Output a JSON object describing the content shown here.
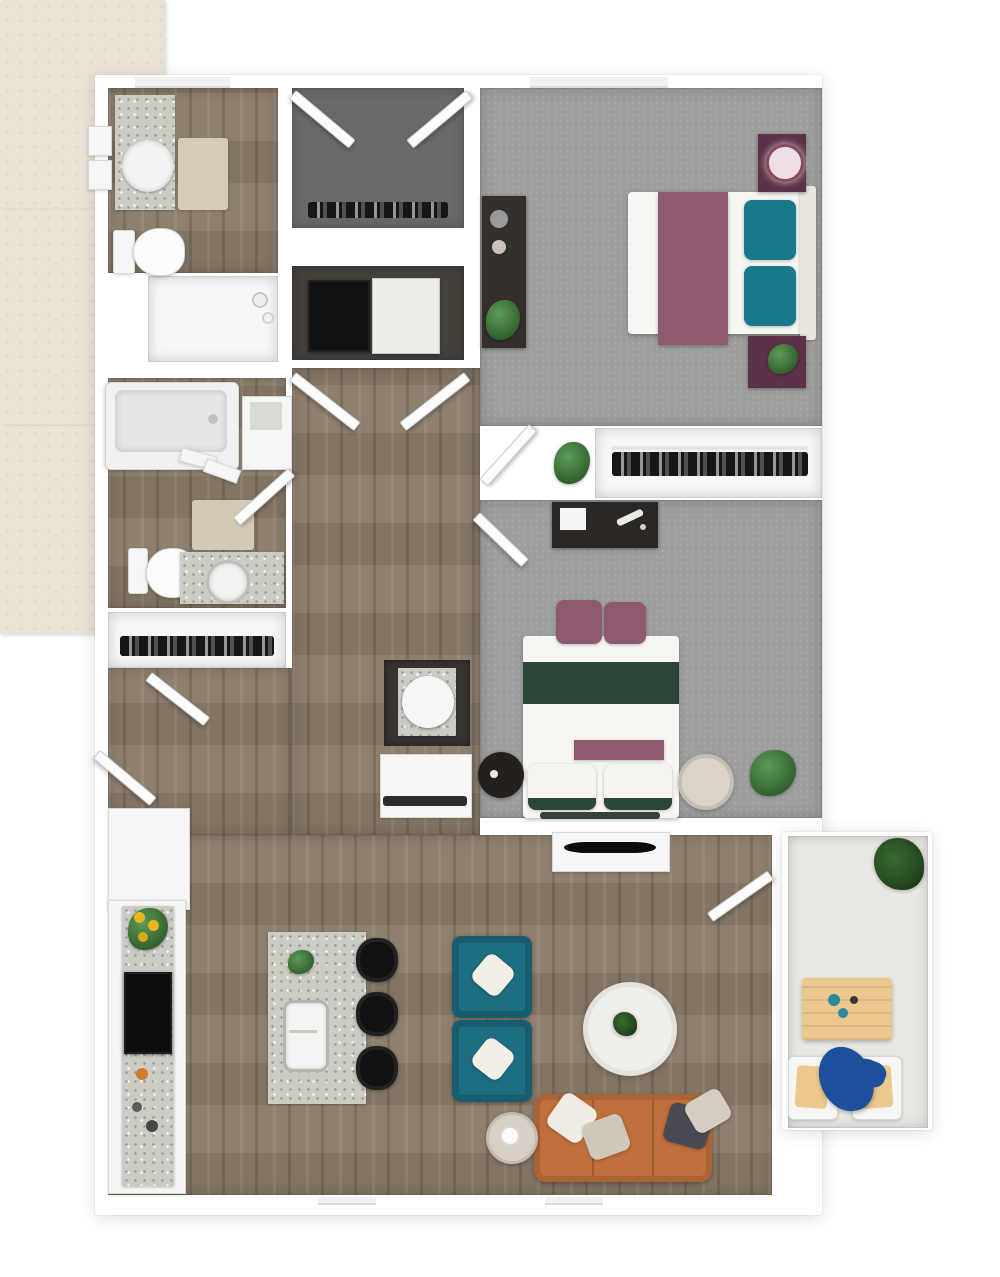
{
  "meta": {
    "type": "3d-floor-plan-render",
    "visible_text": "none",
    "unit_summary": "2-bedroom 2-bathroom apartment with kitchen, living room and patio"
  },
  "palette": {
    "wall": "#ffffff",
    "wood": "#8a7a68",
    "carpet": "#9e9e9e",
    "closet_floor": "#696969",
    "utility_floor": "#46403b",
    "alcove": "#3a3430",
    "white_floor": "#f7f7f5",
    "rug": "#e9e3d5",
    "granite": "#ccccc4",
    "teal": "#1d6e81",
    "teal_pillow": "#18798a",
    "plum": "#8e5a70",
    "plum_dark": "#5d3147",
    "green_dark": "#2a4737",
    "plant_green": "#5d9b57",
    "plant_dark": "#1f3d1b",
    "sofa_orange": "#c06f3d",
    "patio_floor": "#eae8e3",
    "patio_table": "#eac88e",
    "patio_blue": "#1d4f9c",
    "appliance_black": "#111111",
    "mat_beige": "#d6cbb8"
  },
  "rooms": [
    {
      "name": "bathroom-1",
      "position": "top-left",
      "floor": "wood",
      "items": [
        "vanity-with-vessel-sink",
        "wall-towels-x2",
        "bath-mat",
        "toilet",
        "walk-in-shower"
      ]
    },
    {
      "name": "entry-closet",
      "position": "top-center",
      "floor": "dark-gray",
      "items": [
        "double-swing-doors",
        "hanging-rod-with-clothes"
      ]
    },
    {
      "name": "laundry-closet",
      "position": "upper-center",
      "floor": "dark",
      "items": [
        "washer-black",
        "dryer-white",
        "double-swing-doors"
      ]
    },
    {
      "name": "bedroom-1",
      "position": "top-right",
      "floor": "gray-carpet",
      "items": [
        "window",
        "area-rug",
        "bed-with-plum-runner",
        "teal-pillows-x2",
        "nightstand-with-lamp",
        "nightstand-with-plant",
        "dresser-with-decor",
        "plant"
      ]
    },
    {
      "name": "bedroom-1-closet",
      "position": "center-right",
      "floor": "white",
      "items": [
        "hanging-rod-with-clothes",
        "plant-at-entry"
      ]
    },
    {
      "name": "bathroom-2",
      "position": "middle-left",
      "floor": "wood",
      "items": [
        "bathtub",
        "storage-niche",
        "towel-bar",
        "bath-mat",
        "toilet",
        "vanity-with-round-sink",
        "swing-door"
      ]
    },
    {
      "name": "hall-closet",
      "position": "middle-left-lower",
      "floor": "white",
      "items": [
        "hanging-rod-with-clothes"
      ]
    },
    {
      "name": "utility-nook",
      "position": "center",
      "floor": "white",
      "items": [
        "basin-unit-on-granite-base",
        "lower-cubby-with-rail"
      ]
    },
    {
      "name": "bedroom-2",
      "position": "middle-right",
      "floor": "gray-carpet",
      "items": [
        "dresser-with-decor",
        "swing-door",
        "area-rug",
        "bed-with-green-stripe",
        "plum-pillows-x2",
        "white-pillows-x2",
        "round-side-table-dark",
        "round-side-table-light",
        "plant"
      ]
    },
    {
      "name": "living-room",
      "position": "bottom-center",
      "floor": "wood",
      "items": [
        "tv-console",
        "flat-tv",
        "teal-armchairs-x2",
        "round-coffee-table-with-plant",
        "orange-sofa",
        "throw-pillows-x4",
        "round-side-table",
        "area-rug",
        "swing-door-to-patio"
      ]
    },
    {
      "name": "kitchen",
      "position": "bottom-left",
      "floor": "wood",
      "items": [
        "wall-counter-granite",
        "sunflowers",
        "black-range",
        "island-with-farmhouse-sink",
        "island-plant",
        "bar-stools-x3"
      ]
    },
    {
      "name": "patio",
      "position": "bottom-right",
      "floor": "concrete",
      "items": [
        "plant",
        "wood-dining-table",
        "teal-cups",
        "patio-chairs-x2",
        "blue-lounge"
      ]
    }
  ],
  "counts": {
    "bedrooms": 2,
    "bathrooms": 2,
    "closets": 4,
    "bar_stools": 3,
    "teal_armchairs": 2,
    "patio_chairs": 2
  }
}
